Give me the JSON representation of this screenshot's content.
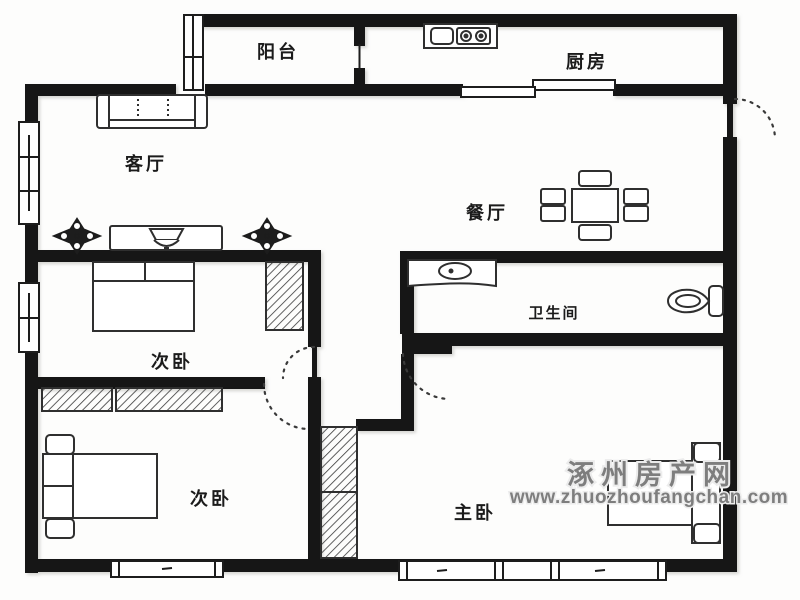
{
  "floor_plan": {
    "rooms": [
      {
        "id": "balcony",
        "label": "阳台"
      },
      {
        "id": "kitchen",
        "label": "厨房"
      },
      {
        "id": "living-room",
        "label": "客厅"
      },
      {
        "id": "dining-room",
        "label": "餐厅"
      },
      {
        "id": "bedroom-upper",
        "label": "次卧"
      },
      {
        "id": "bathroom",
        "label": "卫生间"
      },
      {
        "id": "bedroom-lower",
        "label": "次卧"
      },
      {
        "id": "master-bedroom",
        "label": "主卧"
      }
    ],
    "watermark": {
      "site_name": "涿州房产网",
      "site_url": "www.zhuozhoufangchan.com"
    },
    "colors": {
      "wall": "#161616",
      "furniture": "#2f2f2f",
      "door_arc": "#3a3a3a",
      "label": "#1b1b1b",
      "watermark": "#7e7e7e",
      "background": "#fdfdfc"
    }
  }
}
